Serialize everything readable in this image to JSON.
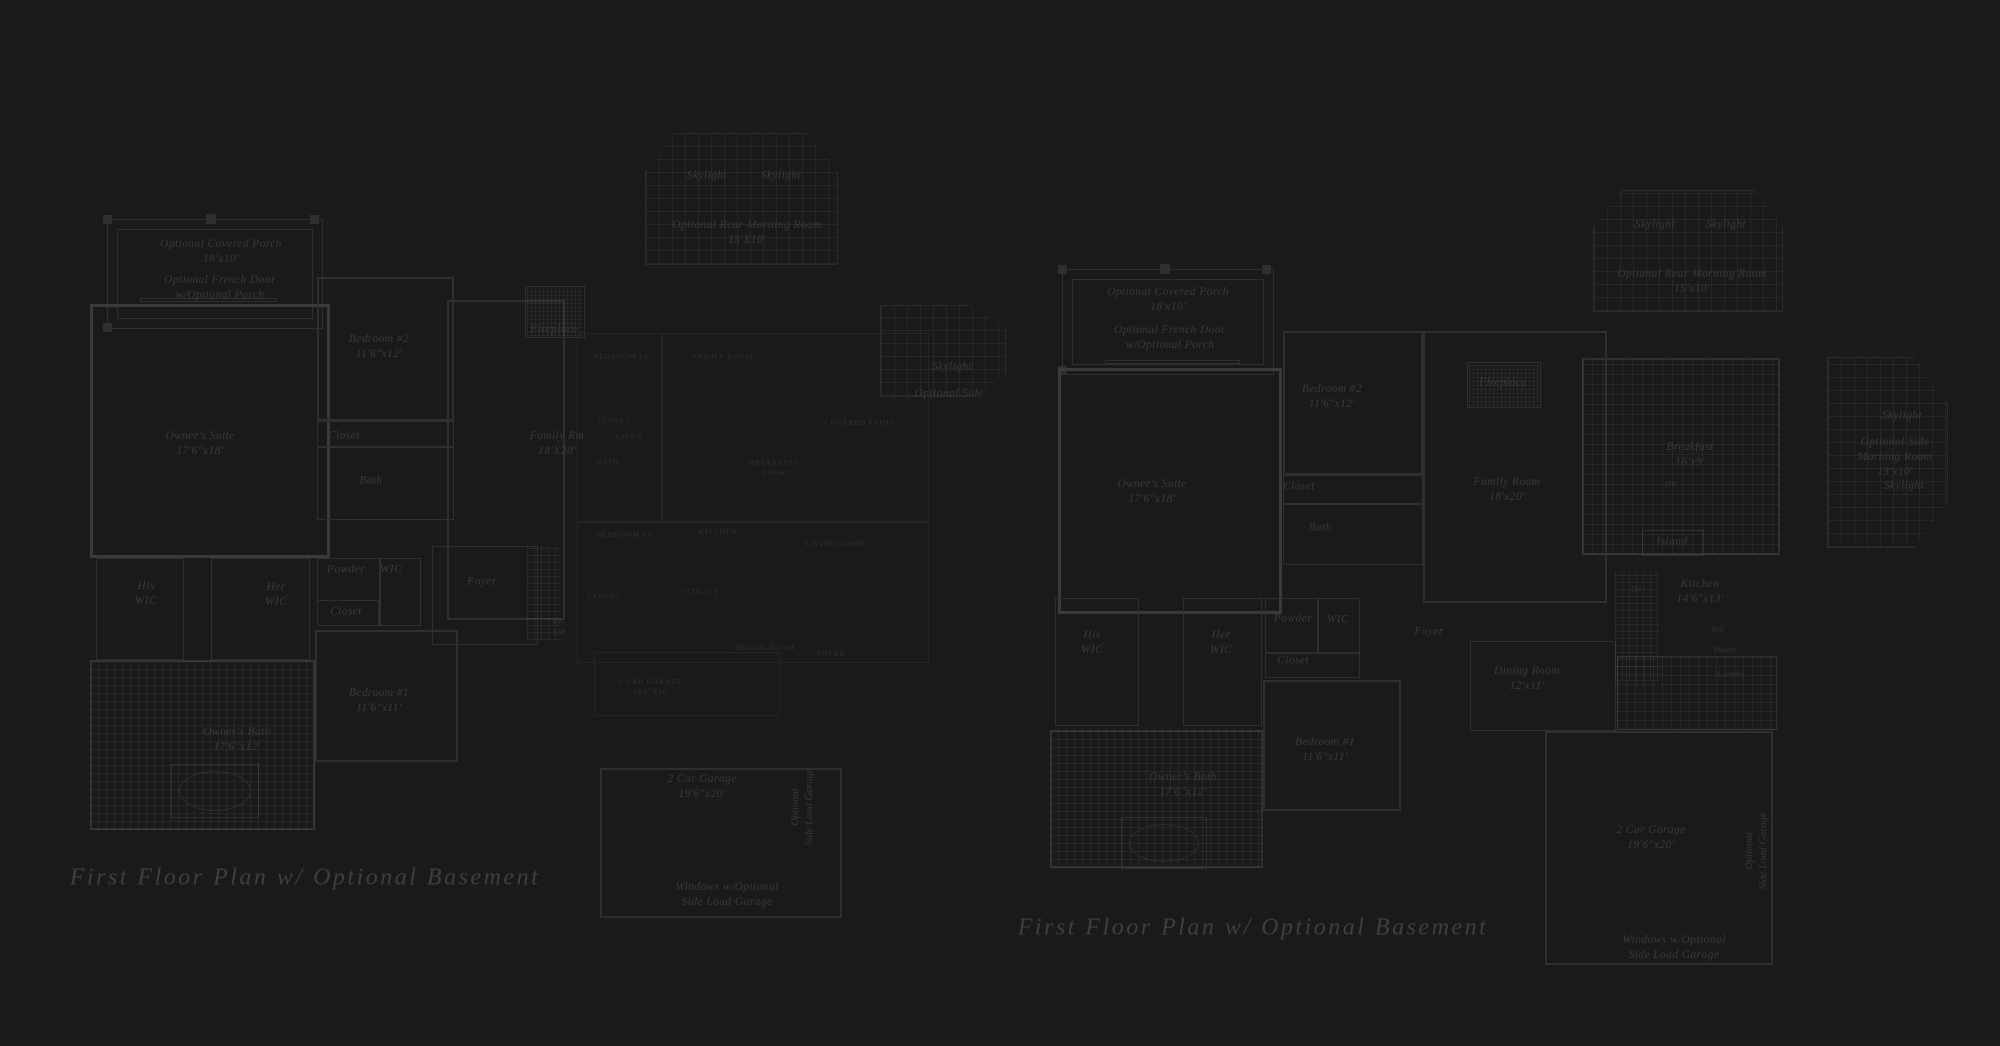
{
  "sheet": {
    "width": 2000,
    "height": 1046,
    "background": "#1a1a1a"
  },
  "colors": {
    "background": "#1a1a1a",
    "wall_main": "#2f2f2f",
    "wall_bold": "#3a3a3a",
    "wall_faint": "#252525",
    "text_script": "#3a3a3a",
    "text_caps": "#303030",
    "text_caption": "#3f3f3f",
    "deck_grid": "rgba(255,255,255,0.05)"
  },
  "captions": [
    {
      "text": "First Floor Plan  w/ Optional Basement",
      "x": 305,
      "y": 878
    },
    {
      "text": "First Floor Plan  w/ Optional Basement",
      "x": 1253,
      "y": 928
    }
  ],
  "plans": [
    {
      "id": "left-floor-plan",
      "wall_color": "#2f2f2f",
      "walls": [
        {
          "x": 103,
          "y": 215,
          "w": 9,
          "h": 9,
          "t": 1,
          "f": 1
        },
        {
          "x": 206,
          "y": 214,
          "w": 10,
          "h": 10,
          "t": 1,
          "f": 1
        },
        {
          "x": 310,
          "y": 215,
          "w": 9,
          "h": 9,
          "t": 1,
          "f": 1
        },
        {
          "x": 103,
          "y": 323,
          "w": 9,
          "h": 9,
          "t": 1,
          "f": 1
        },
        {
          "x": 107,
          "y": 219,
          "w": 216,
          "h": 110,
          "t": 1
        },
        {
          "x": 117,
          "y": 229,
          "w": 196,
          "h": 90,
          "t": 1
        },
        {
          "x": 140,
          "y": 298,
          "w": 137,
          "h": 4,
          "t": 1
        },
        {
          "x": 90,
          "y": 304,
          "w": 240,
          "h": 254,
          "t": 3,
          "c": "#3a3a3a"
        },
        {
          "x": 317,
          "y": 277,
          "w": 137,
          "h": 144,
          "t": 2
        },
        {
          "x": 317,
          "y": 421,
          "w": 137,
          "h": 99,
          "t": 1
        },
        {
          "x": 317,
          "y": 446,
          "w": 137,
          "h": 1,
          "t": 1
        },
        {
          "x": 447,
          "y": 300,
          "w": 118,
          "h": 320,
          "t": 2
        },
        {
          "x": 525,
          "y": 286,
          "w": 60,
          "h": 52,
          "t": 1
        },
        {
          "x": 96,
          "y": 558,
          "w": 88,
          "h": 102,
          "t": 1
        },
        {
          "x": 211,
          "y": 558,
          "w": 99,
          "h": 102,
          "t": 1
        },
        {
          "x": 317,
          "y": 558,
          "w": 104,
          "h": 68,
          "t": 1
        },
        {
          "x": 379,
          "y": 558,
          "w": 1,
          "h": 68,
          "t": 1
        },
        {
          "x": 317,
          "y": 600,
          "w": 62,
          "h": 26,
          "t": 1
        },
        {
          "x": 432,
          "y": 546,
          "w": 106,
          "h": 99,
          "t": 1
        },
        {
          "x": 315,
          "y": 630,
          "w": 143,
          "h": 132,
          "t": 2
        },
        {
          "x": 90,
          "y": 660,
          "w": 225,
          "h": 170,
          "t": 2
        },
        {
          "x": 171,
          "y": 764,
          "w": 88,
          "h": 54,
          "t": 1
        },
        {
          "x": 600,
          "y": 768,
          "w": 242,
          "h": 150,
          "t": 2
        }
      ],
      "decks": [
        {
          "x": 645,
          "y": 133,
          "w": 193,
          "h": 132,
          "cell": 13,
          "clip": "polygon(15% 0, 85% 0, 100% 30%, 100% 100%, 0 100%, 0 30%)"
        },
        {
          "x": 880,
          "y": 305,
          "w": 126,
          "h": 92,
          "cell": 13,
          "clip": "polygon(0 0, 72% 0, 100% 24%, 100% 76%, 72% 100%, 0 100%)"
        },
        {
          "x": 90,
          "y": 660,
          "w": 225,
          "h": 170,
          "cell": 8
        },
        {
          "x": 527,
          "y": 288,
          "w": 56,
          "h": 48,
          "cell": 4
        },
        {
          "x": 527,
          "y": 546,
          "w": 34,
          "h": 94,
          "cell": 7
        }
      ],
      "ovals": [
        {
          "x": 179,
          "y": 771,
          "w": 72,
          "h": 40
        }
      ],
      "labels": [
        {
          "t": "Optional Covered Porch\n18'x10'",
          "x": 221,
          "y": 252,
          "s": "script"
        },
        {
          "t": "Optional French Door\nw/Optional Porch",
          "x": 220,
          "y": 288,
          "s": "script"
        },
        {
          "t": "Owner's Suite\n17'6\"x18'",
          "x": 200,
          "y": 444,
          "s": "script"
        },
        {
          "t": "Bedroom #2\n11'6\"x12'",
          "x": 379,
          "y": 347,
          "s": "script"
        },
        {
          "t": "Closet",
          "x": 344,
          "y": 436,
          "s": "script"
        },
        {
          "t": "Bath",
          "x": 371,
          "y": 481,
          "s": "script"
        },
        {
          "t": "His\nWIC",
          "x": 146,
          "y": 594,
          "s": "script"
        },
        {
          "t": "Her\nWIC",
          "x": 276,
          "y": 595,
          "s": "script"
        },
        {
          "t": "Powder",
          "x": 346,
          "y": 570,
          "s": "script"
        },
        {
          "t": "WIC",
          "x": 391,
          "y": 570,
          "s": "script"
        },
        {
          "t": "Closet",
          "x": 346,
          "y": 612,
          "s": "script"
        },
        {
          "t": "Foyer",
          "x": 482,
          "y": 582,
          "s": "script"
        },
        {
          "t": "Bedroom #1\n11'6\"x11'",
          "x": 379,
          "y": 701,
          "s": "script"
        },
        {
          "t": "Owner's Bath\n17'6\"x12'",
          "x": 237,
          "y": 740,
          "s": "script"
        },
        {
          "t": "Family Rm\n18'X20'",
          "x": 557,
          "y": 444,
          "s": "script"
        },
        {
          "t": "Fireplace",
          "x": 554,
          "y": 330,
          "s": "script"
        },
        {
          "t": "Dn.\n12R",
          "x": 559,
          "y": 627,
          "s": "tiny"
        },
        {
          "t": "Skylight",
          "x": 707,
          "y": 176,
          "s": "script"
        },
        {
          "t": "Skylight",
          "x": 781,
          "y": 176,
          "s": "script"
        },
        {
          "t": "Optional Rear Morning Room\n15'X10'",
          "x": 747,
          "y": 233,
          "s": "script"
        },
        {
          "t": "2 Car Garage\n19'6\"x20'",
          "x": 702,
          "y": 787,
          "s": "script"
        },
        {
          "t": "Optional\nSide Load Garage",
          "x": 803,
          "y": 807,
          "s": "vert"
        },
        {
          "t": "Windows w/Optional\nSide Load Garage",
          "x": 727,
          "y": 895,
          "s": "script"
        },
        {
          "t": "Skylight",
          "x": 952,
          "y": 367,
          "s": "script"
        },
        {
          "t": "Optional Side",
          "x": 949,
          "y": 394,
          "s": "script"
        }
      ]
    },
    {
      "id": "center-floor-plan",
      "wall_color": "#252525",
      "walls": [
        {
          "x": 577,
          "y": 333,
          "w": 352,
          "h": 330,
          "t": 1
        },
        {
          "x": 661,
          "y": 333,
          "w": 1,
          "h": 187,
          "t": 1
        },
        {
          "x": 577,
          "y": 521,
          "w": 352,
          "h": 1,
          "t": 1
        },
        {
          "x": 594,
          "y": 652,
          "w": 186,
          "h": 64,
          "t": 1
        }
      ],
      "decks": [],
      "ovals": [],
      "labels": [
        {
          "t": "BEDROOM #2",
          "x": 621,
          "y": 357,
          "s": "caps"
        },
        {
          "t": "FAMILY ROOM",
          "x": 723,
          "y": 357,
          "s": "caps"
        },
        {
          "t": "CLOSET",
          "x": 614,
          "y": 421,
          "s": "caps"
        },
        {
          "t": "LINEN",
          "x": 629,
          "y": 437,
          "s": "caps"
        },
        {
          "t": "BATH",
          "x": 608,
          "y": 462,
          "s": "caps"
        },
        {
          "t": "BREAKFAST\nNOOK",
          "x": 774,
          "y": 468,
          "s": "caps"
        },
        {
          "t": "COVERED PATIO",
          "x": 859,
          "y": 423,
          "s": "caps"
        },
        {
          "t": "BEDROOM #3",
          "x": 624,
          "y": 535,
          "s": "caps"
        },
        {
          "t": "KITCHEN",
          "x": 718,
          "y": 532,
          "s": "caps"
        },
        {
          "t": "LIVING ROOM",
          "x": 835,
          "y": 544,
          "s": "caps"
        },
        {
          "t": "CLOSET",
          "x": 604,
          "y": 596,
          "s": "caps"
        },
        {
          "t": "UTILITY",
          "x": 702,
          "y": 592,
          "s": "caps"
        },
        {
          "t": "DINING ROOM",
          "x": 765,
          "y": 648,
          "s": "caps"
        },
        {
          "t": "FOYER",
          "x": 831,
          "y": 654,
          "s": "caps"
        },
        {
          "t": "2 CAR GARAGE\n19'6\"X20'",
          "x": 651,
          "y": 687,
          "s": "caps"
        }
      ]
    },
    {
      "id": "right-floor-plan",
      "wall_color": "#2f2f2f",
      "walls": [
        {
          "x": 1058,
          "y": 265,
          "w": 9,
          "h": 9,
          "t": 1,
          "f": 1
        },
        {
          "x": 1160,
          "y": 264,
          "w": 10,
          "h": 10,
          "t": 1,
          "f": 1
        },
        {
          "x": 1262,
          "y": 265,
          "w": 9,
          "h": 9,
          "t": 1,
          "f": 1
        },
        {
          "x": 1058,
          "y": 366,
          "w": 9,
          "h": 9,
          "t": 1,
          "f": 1
        },
        {
          "x": 1062,
          "y": 269,
          "w": 212,
          "h": 106,
          "t": 1
        },
        {
          "x": 1072,
          "y": 279,
          "w": 192,
          "h": 86,
          "t": 1
        },
        {
          "x": 1105,
          "y": 360,
          "w": 135,
          "h": 4,
          "t": 1
        },
        {
          "x": 1058,
          "y": 368,
          "w": 224,
          "h": 246,
          "t": 3,
          "c": "#3a3a3a"
        },
        {
          "x": 1283,
          "y": 331,
          "w": 140,
          "h": 144,
          "t": 2
        },
        {
          "x": 1283,
          "y": 475,
          "w": 140,
          "h": 90,
          "t": 1
        },
        {
          "x": 1283,
          "y": 503,
          "w": 140,
          "h": 1,
          "t": 1
        },
        {
          "x": 1423,
          "y": 331,
          "w": 184,
          "h": 272,
          "t": 2
        },
        {
          "x": 1467,
          "y": 362,
          "w": 74,
          "h": 46,
          "t": 1
        },
        {
          "x": 1055,
          "y": 598,
          "w": 84,
          "h": 128,
          "t": 1
        },
        {
          "x": 1183,
          "y": 598,
          "w": 79,
          "h": 128,
          "t": 1
        },
        {
          "x": 1265,
          "y": 598,
          "w": 95,
          "h": 55,
          "t": 1
        },
        {
          "x": 1317,
          "y": 598,
          "w": 1,
          "h": 55,
          "t": 1
        },
        {
          "x": 1265,
          "y": 653,
          "w": 95,
          "h": 25,
          "t": 1
        },
        {
          "x": 1263,
          "y": 680,
          "w": 138,
          "h": 131,
          "t": 2
        },
        {
          "x": 1050,
          "y": 730,
          "w": 213,
          "h": 138,
          "t": 2
        },
        {
          "x": 1121,
          "y": 817,
          "w": 86,
          "h": 52,
          "t": 1
        },
        {
          "x": 1470,
          "y": 641,
          "w": 146,
          "h": 90,
          "t": 1
        },
        {
          "x": 1582,
          "y": 358,
          "w": 198,
          "h": 197,
          "t": 2
        },
        {
          "x": 1642,
          "y": 530,
          "w": 62,
          "h": 26,
          "t": 1
        },
        {
          "x": 1617,
          "y": 656,
          "w": 160,
          "h": 74,
          "t": 1
        },
        {
          "x": 1545,
          "y": 731,
          "w": 228,
          "h": 234,
          "t": 2
        }
      ],
      "decks": [
        {
          "x": 1593,
          "y": 190,
          "w": 190,
          "h": 122,
          "cell": 13,
          "clip": "polygon(15% 0, 85% 0, 100% 30%, 100% 100%, 0 100%, 0 30%)"
        },
        {
          "x": 1827,
          "y": 357,
          "w": 121,
          "h": 191,
          "cell": 13,
          "clip": "polygon(0 0, 72% 0, 100% 24%, 100% 76%, 72% 100%, 0 100%)"
        },
        {
          "x": 1050,
          "y": 730,
          "w": 213,
          "h": 138,
          "cell": 8
        },
        {
          "x": 1582,
          "y": 358,
          "w": 198,
          "h": 197,
          "cell": 10
        },
        {
          "x": 1615,
          "y": 571,
          "w": 44,
          "h": 110,
          "cell": 7
        },
        {
          "x": 1617,
          "y": 656,
          "w": 160,
          "h": 74,
          "cell": 9
        },
        {
          "x": 1469,
          "y": 364,
          "w": 70,
          "h": 42,
          "cell": 4
        }
      ],
      "ovals": [
        {
          "x": 1129,
          "y": 824,
          "w": 70,
          "h": 38
        }
      ],
      "labels": [
        {
          "t": "Optional Covered Porch\n18'x10'",
          "x": 1168,
          "y": 300,
          "s": "script"
        },
        {
          "t": "Optional French Door\nw/Optional Porch",
          "x": 1170,
          "y": 338,
          "s": "script"
        },
        {
          "t": "Owner's Suite\n17'6\"x18'",
          "x": 1152,
          "y": 492,
          "s": "script"
        },
        {
          "t": "Bedroom #2\n11'6\"x12'",
          "x": 1332,
          "y": 397,
          "s": "script"
        },
        {
          "t": "Closet",
          "x": 1299,
          "y": 487,
          "s": "script"
        },
        {
          "t": "Bath",
          "x": 1320,
          "y": 528,
          "s": "script"
        },
        {
          "t": "Family Room\n18'x20'",
          "x": 1507,
          "y": 490,
          "s": "script"
        },
        {
          "t": "Fireplace",
          "x": 1503,
          "y": 383,
          "s": "script"
        },
        {
          "t": "His\nWIC",
          "x": 1092,
          "y": 643,
          "s": "script"
        },
        {
          "t": "Her\nWIC",
          "x": 1221,
          "y": 643,
          "s": "script"
        },
        {
          "t": "Powder",
          "x": 1293,
          "y": 619,
          "s": "script"
        },
        {
          "t": "WIC",
          "x": 1338,
          "y": 620,
          "s": "script"
        },
        {
          "t": "Closet",
          "x": 1293,
          "y": 661,
          "s": "script"
        },
        {
          "t": "Foyer",
          "x": 1429,
          "y": 632,
          "s": "script"
        },
        {
          "t": "Bedroom #1\n11'6\"x11'",
          "x": 1325,
          "y": 750,
          "s": "script"
        },
        {
          "t": "Owner's Bath\n17'6\"x12'",
          "x": 1183,
          "y": 785,
          "s": "script"
        },
        {
          "t": "Dining Room\n12'x11'",
          "x": 1527,
          "y": 679,
          "s": "script"
        },
        {
          "t": "Breakfast\n16'x9'",
          "x": 1690,
          "y": 455,
          "s": "script"
        },
        {
          "t": "DW",
          "x": 1671,
          "y": 485,
          "s": "tiny"
        },
        {
          "t": "Island",
          "x": 1672,
          "y": 542,
          "s": "script"
        },
        {
          "t": "Kitchen\n14'6\"x13'",
          "x": 1700,
          "y": 592,
          "s": "script"
        },
        {
          "t": "Ref.",
          "x": 1718,
          "y": 630,
          "s": "tiny"
        },
        {
          "t": "Dn",
          "x": 1636,
          "y": 590,
          "s": "tiny"
        },
        {
          "t": "Pantry",
          "x": 1725,
          "y": 651,
          "s": "tiny"
        },
        {
          "t": "Laundry",
          "x": 1731,
          "y": 675,
          "s": "tiny"
        },
        {
          "t": "2 Car Garage\n19'6\"x20'",
          "x": 1651,
          "y": 838,
          "s": "script"
        },
        {
          "t": "Optional\nSide Load Garage",
          "x": 1757,
          "y": 851,
          "s": "vert"
        },
        {
          "t": "Windows w/Optional\nSide Load Garage",
          "x": 1674,
          "y": 948,
          "s": "script"
        },
        {
          "t": "Skylight",
          "x": 1655,
          "y": 225,
          "s": "script"
        },
        {
          "t": "Skylight",
          "x": 1726,
          "y": 225,
          "s": "script"
        },
        {
          "t": "Optional Rear Morning Room\n15'x10'",
          "x": 1692,
          "y": 282,
          "s": "script"
        },
        {
          "t": "Skylight",
          "x": 1902,
          "y": 416,
          "s": "script"
        },
        {
          "t": "Optional Side\nMorning Room\n13'x10'",
          "x": 1895,
          "y": 458,
          "s": "script"
        },
        {
          "t": "Skylight",
          "x": 1904,
          "y": 486,
          "s": "script"
        }
      ]
    }
  ]
}
